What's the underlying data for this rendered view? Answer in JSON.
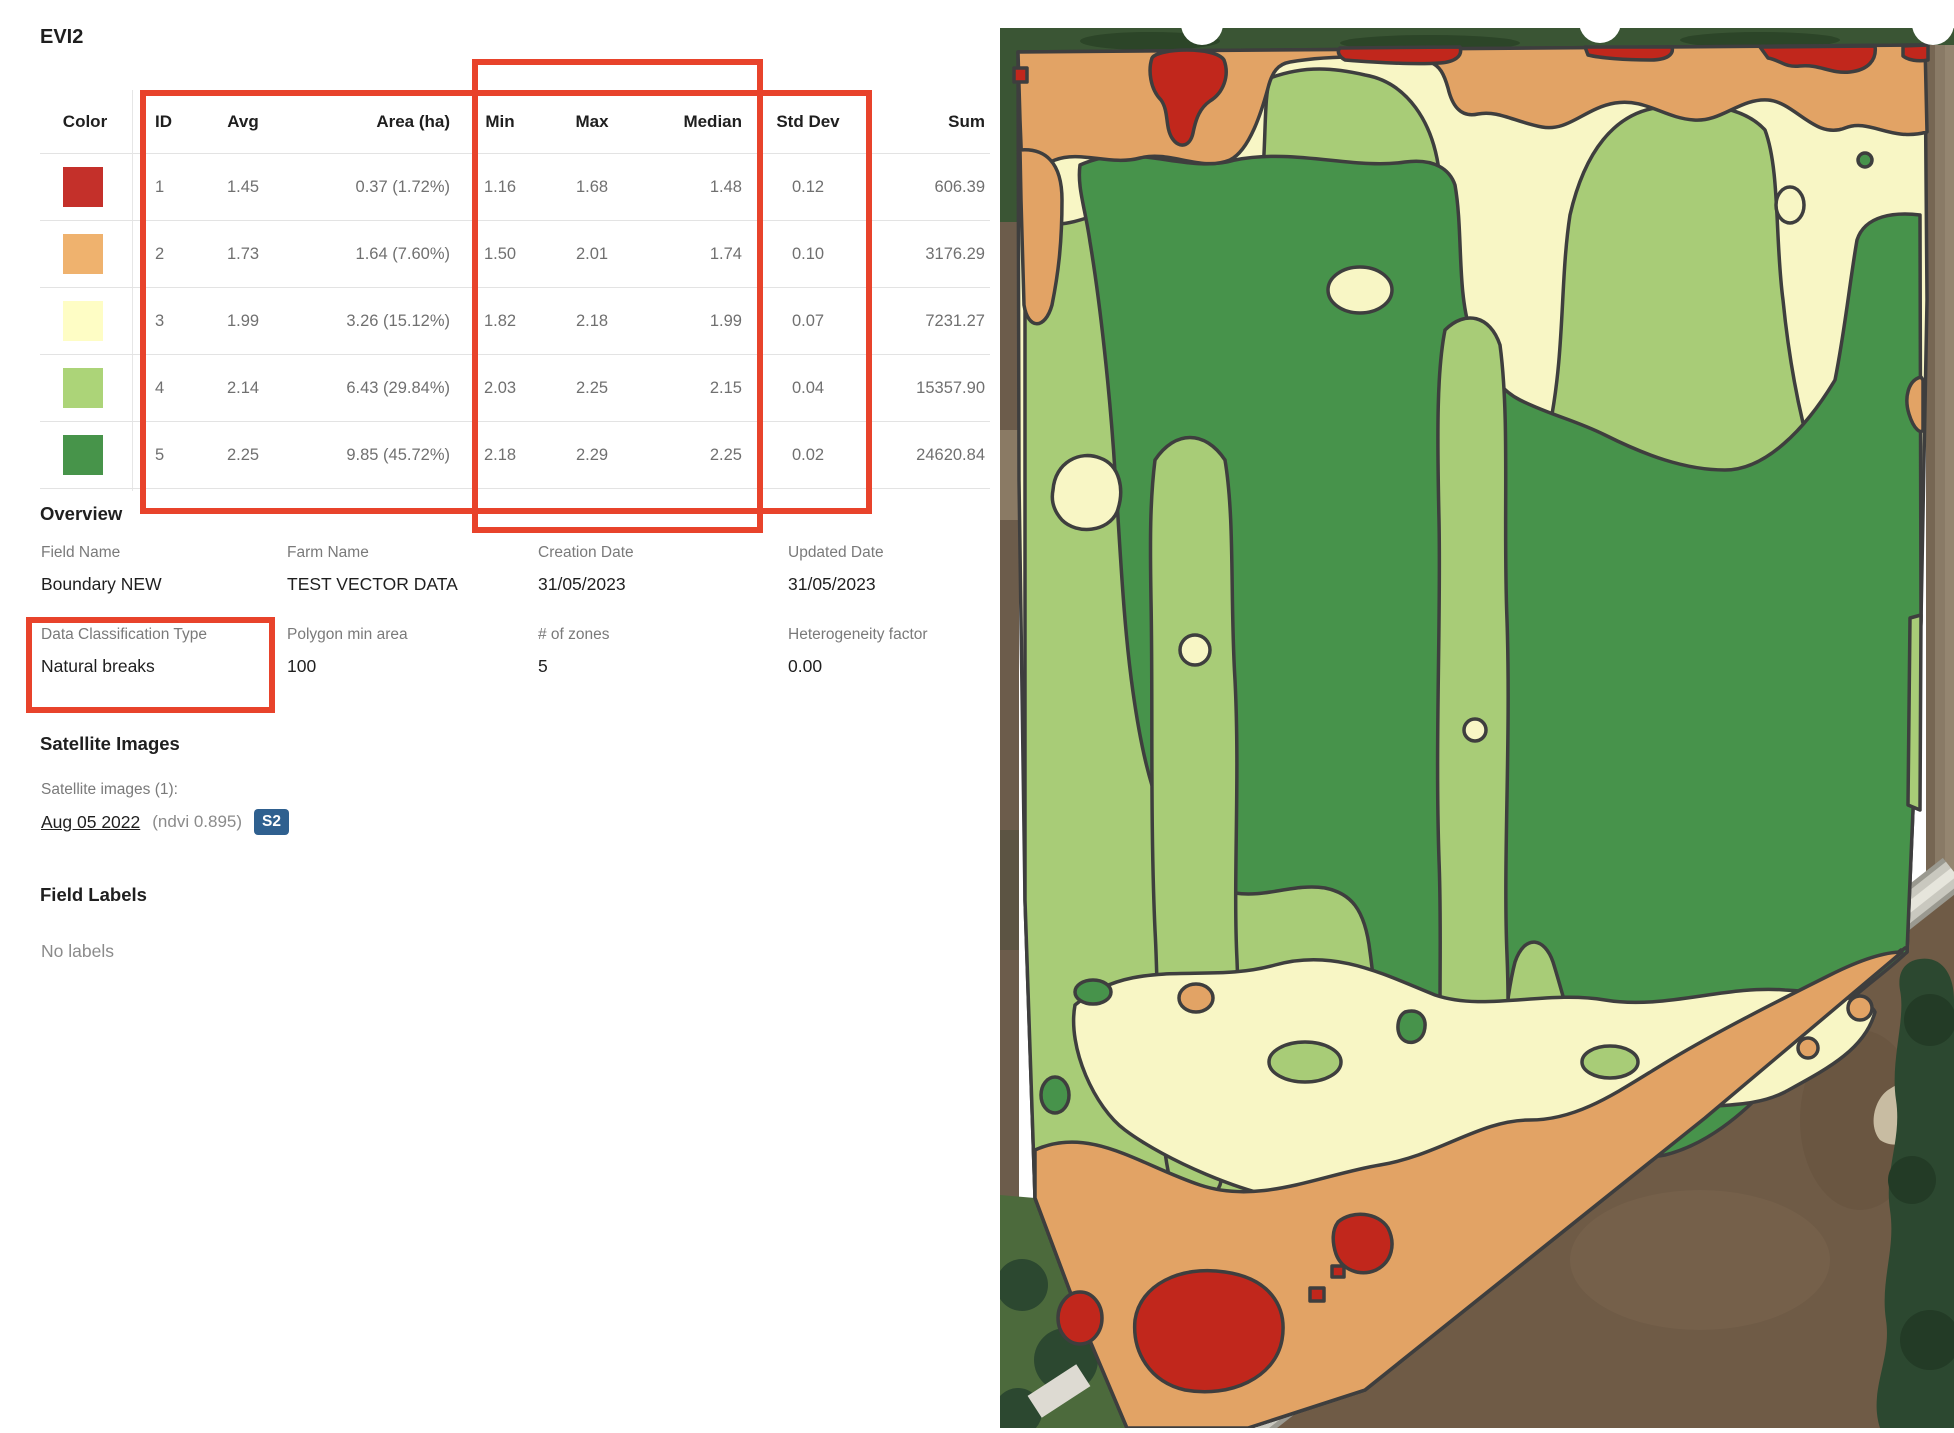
{
  "title": "EVI2",
  "table": {
    "headers": [
      "Color",
      "ID",
      "Avg",
      "Area (ha)",
      "Min",
      "Max",
      "Median",
      "Std Dev",
      "Sum"
    ],
    "rows": [
      {
        "color": "#C4302A",
        "id": "1",
        "avg": "1.45",
        "area": "0.37 (1.72%)",
        "min": "1.16",
        "max": "1.68",
        "median": "1.48",
        "std": "0.12",
        "sum": "606.39"
      },
      {
        "color": "#EFB26E",
        "id": "2",
        "avg": "1.73",
        "area": "1.64 (7.60%)",
        "min": "1.50",
        "max": "2.01",
        "median": "1.74",
        "std": "0.10",
        "sum": "3176.29"
      },
      {
        "color": "#FEFDC5",
        "id": "3",
        "avg": "1.99",
        "area": "3.26 (15.12%)",
        "min": "1.82",
        "max": "2.18",
        "median": "1.99",
        "std": "0.07",
        "sum": "7231.27"
      },
      {
        "color": "#ACD478",
        "id": "4",
        "avg": "2.14",
        "area": "6.43 (29.84%)",
        "min": "2.03",
        "max": "2.25",
        "median": "2.15",
        "std": "0.04",
        "sum": "15357.90"
      },
      {
        "color": "#47944A",
        "id": "5",
        "avg": "2.25",
        "area": "9.85 (45.72%)",
        "min": "2.18",
        "max": "2.29",
        "median": "2.25",
        "std": "0.02",
        "sum": "24620.84"
      }
    ]
  },
  "overview": {
    "heading": "Overview",
    "fields": [
      {
        "label": "Field Name",
        "value": "Boundary NEW"
      },
      {
        "label": "Farm Name",
        "value": "TEST VECTOR DATA"
      },
      {
        "label": "Creation Date",
        "value": "31/05/2023"
      },
      {
        "label": "Updated Date",
        "value": "31/05/2023"
      },
      {
        "label": "Data Classification Type",
        "value": "Natural breaks"
      },
      {
        "label": "Polygon min area",
        "value": "100"
      },
      {
        "label": "# of zones",
        "value": "5"
      },
      {
        "label": "Heterogeneity factor",
        "value": "0.00"
      }
    ]
  },
  "satellite": {
    "heading": "Satellite Images",
    "count_label": "Satellite images (1):",
    "link": "Aug 05 2022",
    "ndvi": "(ndvi 0.895)",
    "badge": "S2",
    "badge_color": "#2F608F"
  },
  "field_labels": {
    "heading": "Field Labels",
    "empty": "No labels"
  },
  "annotations": {
    "highlight_color": "#E8432B"
  },
  "map": {
    "zones": {
      "red": "#C1271C",
      "orange": "#E2A365",
      "yellow": "#F8F6C5",
      "lightgreen": "#A8CC77",
      "darkgreen": "#47934B",
      "outline": "#3E3E3E"
    },
    "surround": {
      "page": "#FFFFFF",
      "trees": "#3A5534",
      "treedark": "#2C4528",
      "soil": "#6C5C4B",
      "grass": "#4C6A3C",
      "treeline": "#2C4830",
      "road": "#C9C8BF",
      "roadedge": "#9A9990",
      "roadcenter": "#E6E5DC",
      "field": "#6F5B46",
      "fieldlight": "#7A654E",
      "track": "#897A66",
      "building": "#DDDAD2",
      "handle": "#FFFFFF"
    }
  }
}
